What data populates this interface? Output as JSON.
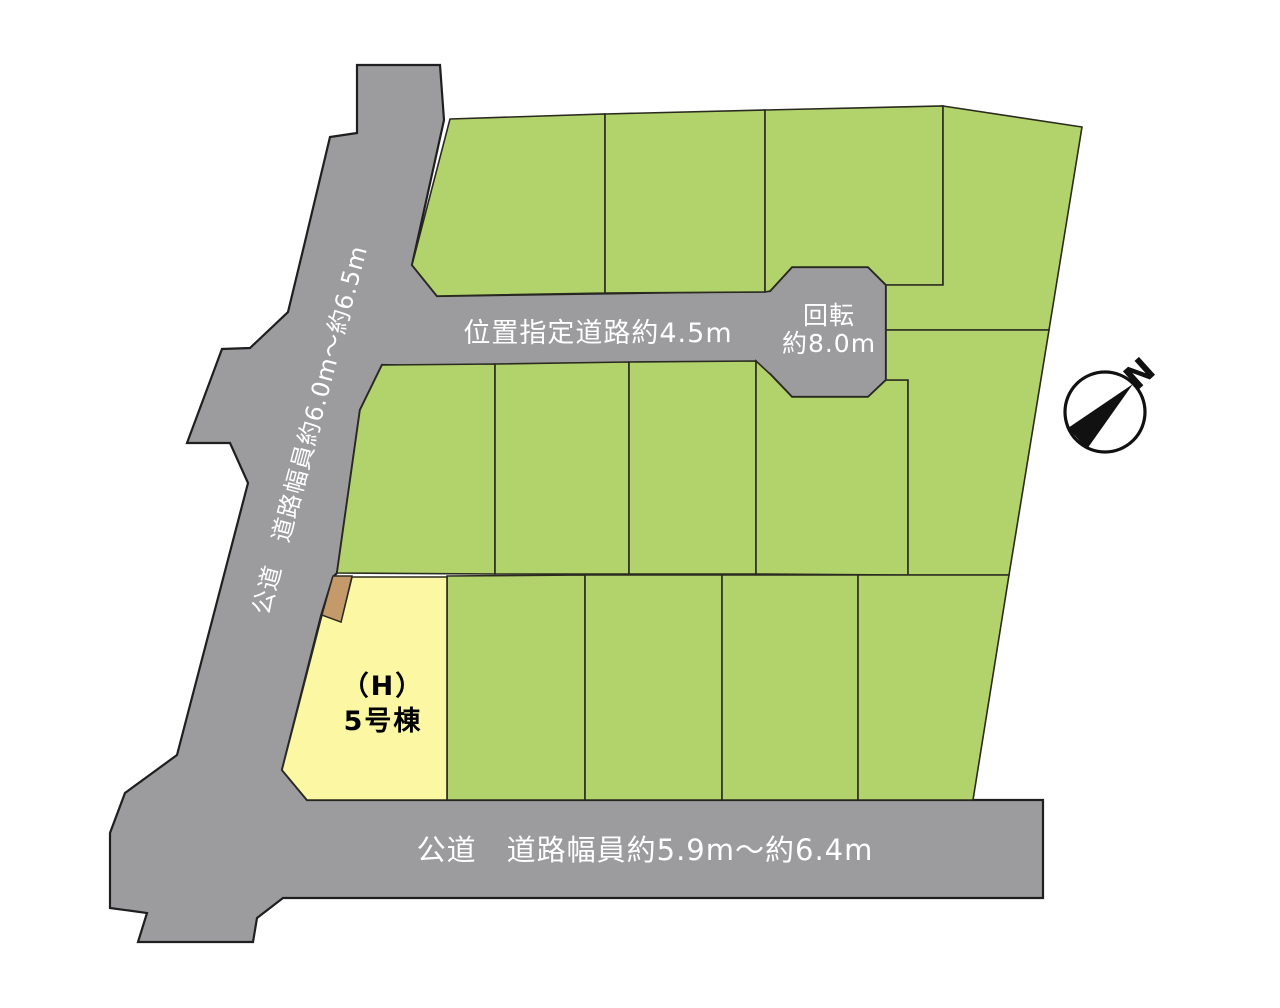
{
  "colors": {
    "background": "#ffffff",
    "road": "#9c9b9e",
    "plot_green": "#b2d36b",
    "plot_yellow": "#fbf7a3",
    "setback_brown": "#c59a6a",
    "outline": "#1f1f1f",
    "road_text": "#ffffff",
    "plot_text": "#000000",
    "compass_black": "#111111"
  },
  "site_plan": {
    "roads": {
      "left_road_label": "公道　道路幅員約6.0m〜約6.5m",
      "designated_road_label": "位置指定道路約4.5m",
      "turnaround_label_line1": "回転",
      "turnaround_label_line2": "約8.0m",
      "bottom_road_label": "公道　道路幅員約5.9m〜約6.4m"
    },
    "highlighted_plot": {
      "name_line1": "（H）",
      "name_line2": "5号棟"
    },
    "compass": {
      "north_label": "N"
    }
  }
}
